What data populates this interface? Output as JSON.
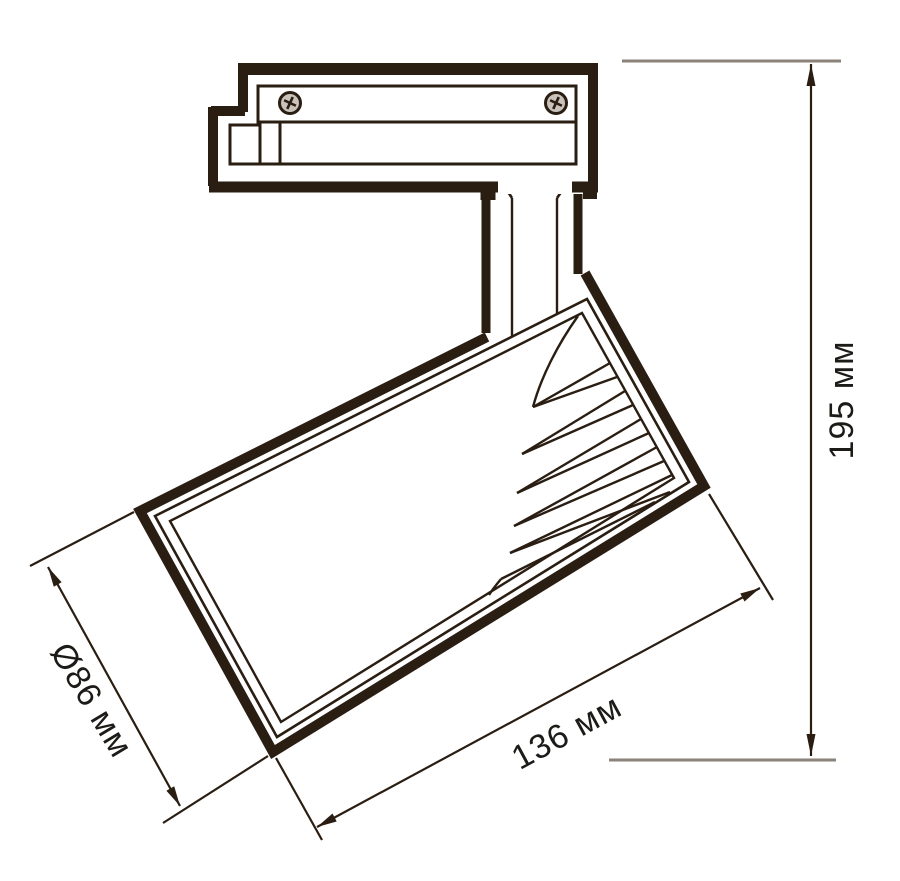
{
  "drawing": {
    "type": "technical-dimension-diagram",
    "subject": "track-mounted LED spotlight, side view with overall dimensions",
    "labels": {
      "diameter": "Ø86 мм",
      "length": "136 мм",
      "height": "195 мм"
    },
    "icons": {
      "screw_left": "phillips-screw-icon",
      "screw_right": "phillips-screw-icon"
    }
  },
  "colors": {
    "line": "#2a1d12",
    "extension": "#8b8279",
    "text": "#1d1b18",
    "screw": "#c9c3bc",
    "bg": "#ffffff"
  }
}
